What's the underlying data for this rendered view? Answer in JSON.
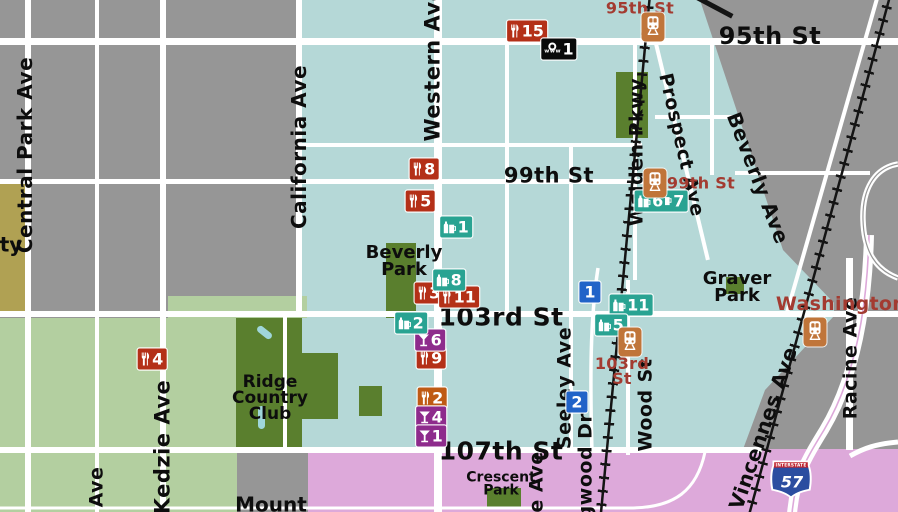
{
  "colors": {
    "background_gray": "#969696",
    "beverly_teal": "#b5d8d7",
    "golf_light_green": "#b3cfa0",
    "park_dark_green": "#5a7f2e",
    "olive_area": "#b0a153",
    "mount_greenwood_pink": "#dda9da",
    "road_white": "#ffffff",
    "railroad_black": "#141414",
    "restaurant_red": "#b43018",
    "cafe_orange": "#bf5a14",
    "bar_purple": "#8e2b8c",
    "pub_teal": "#29a392",
    "poi_blue": "#2163c8",
    "internet_black": "#0a0a0a",
    "station_orange": "#c0753a",
    "station_label_red": "#a33b31",
    "interstate_blue": "#2b4da0",
    "interstate_red": "#c02531"
  },
  "street_labels": [
    {
      "name": "95th-st",
      "text": "95th St",
      "x": 770,
      "y": 36,
      "size": 24,
      "rot": 0
    },
    {
      "name": "99th-st",
      "text": "99th St",
      "x": 549,
      "y": 176,
      "size": 21,
      "rot": 0
    },
    {
      "name": "103rd-st",
      "text": "103rd St",
      "x": 501,
      "y": 317,
      "size": 25,
      "rot": 0
    },
    {
      "name": "107th-st",
      "text": "107th St",
      "x": 501,
      "y": 451,
      "size": 25,
      "rot": 0
    },
    {
      "name": "central-park-ave",
      "text": "Central Park Ave",
      "x": 25,
      "y": 155,
      "size": 20,
      "rot": -90
    },
    {
      "name": "kedzie-ave",
      "text": "Kedzie Ave",
      "x": 163,
      "y": 447,
      "size": 21,
      "rot": -90
    },
    {
      "name": "california-ave",
      "text": "California Ave",
      "x": 299,
      "y": 147,
      "size": 20,
      "rot": -90
    },
    {
      "name": "western-ave",
      "text": "Western Ave",
      "x": 433,
      "y": 64,
      "size": 21,
      "rot": -90
    },
    {
      "name": "walden-pkwy",
      "text": "Walden Pkwy",
      "x": 637,
      "y": 152,
      "size": 19,
      "rot": -90
    },
    {
      "name": "prospect-ave",
      "text": "Prospect Ave",
      "x": 681,
      "y": 145,
      "size": 19,
      "rot": 77
    },
    {
      "name": "beverly-ave",
      "text": "Beverly Ave",
      "x": 758,
      "y": 178,
      "size": 20,
      "rot": 69
    },
    {
      "name": "seeley-ave",
      "text": "Seeley Ave",
      "x": 565,
      "y": 388,
      "size": 19,
      "rot": -90
    },
    {
      "name": "wood-st",
      "text": "Wood St",
      "x": 646,
      "y": 405,
      "size": 19,
      "rot": -90
    },
    {
      "name": "longwood-dr-partial",
      "text": "gwood Dr",
      "x": 586,
      "y": 466,
      "size": 19,
      "rot": -90
    },
    {
      "name": "ave-partial-east",
      "text": "e Ave",
      "x": 537,
      "y": 482,
      "size": 19,
      "rot": -90
    },
    {
      "name": "vincennes-ave",
      "text": "Vincennes Ave",
      "x": 763,
      "y": 428,
      "size": 20,
      "rot": -71
    },
    {
      "name": "racine-ave",
      "text": "Racine Ave",
      "x": 851,
      "y": 358,
      "size": 19,
      "rot": -90
    },
    {
      "name": "ave-partial-west",
      "text": "Ave",
      "x": 97,
      "y": 487,
      "size": 19,
      "rot": -90
    }
  ],
  "place_labels": [
    {
      "name": "beverly-park",
      "lines": [
        "Beverly",
        "Park"
      ],
      "x": 404,
      "y": 261,
      "size": 18
    },
    {
      "name": "graver-park",
      "lines": [
        "Graver",
        "Park"
      ],
      "x": 737,
      "y": 287,
      "size": 18
    },
    {
      "name": "ridge-country-club",
      "lines": [
        "Ridge",
        "Country",
        "Club"
      ],
      "x": 270,
      "y": 398,
      "size": 17
    },
    {
      "name": "crescent-park",
      "lines": [
        "Crescent",
        "Park"
      ],
      "x": 501,
      "y": 485,
      "size": 14
    },
    {
      "name": "mount-partial",
      "lines": [
        "Mount"
      ],
      "x": 271,
      "y": 505,
      "size": 20
    },
    {
      "name": "ty-partial",
      "lines": [
        "ty"
      ],
      "x": 11,
      "y": 245,
      "size": 20
    }
  ],
  "station_labels": [
    {
      "name": "station-95th",
      "lines": [
        "95th St"
      ],
      "x": 640,
      "y": 8,
      "size": 16
    },
    {
      "name": "station-99th",
      "lines": [
        "99th St"
      ],
      "x": 701,
      "y": 183,
      "size": 16
    },
    {
      "name": "station-103rd",
      "lines": [
        "103rd",
        "St"
      ],
      "x": 622,
      "y": 371,
      "size": 16
    },
    {
      "name": "station-washington",
      "lines": [
        "Washington"
      ],
      "x": 841,
      "y": 304,
      "size": 19
    }
  ],
  "stations": [
    {
      "name": "95th",
      "x": 653,
      "y": 27
    },
    {
      "name": "99th",
      "x": 655,
      "y": 183
    },
    {
      "name": "103rd",
      "x": 630,
      "y": 342
    },
    {
      "name": "washington",
      "x": 815,
      "y": 332
    }
  ],
  "markers": [
    {
      "type": "restaurant",
      "num": "15",
      "x": 527,
      "y": 31
    },
    {
      "type": "restaurant",
      "num": "8",
      "x": 424,
      "y": 169
    },
    {
      "type": "restaurant",
      "num": "5",
      "x": 420,
      "y": 201
    },
    {
      "type": "restaurant",
      "num": "3",
      "x": 429,
      "y": 293
    },
    {
      "type": "restaurant",
      "num": "11",
      "x": 459,
      "y": 297
    },
    {
      "type": "restaurant",
      "num": "9",
      "x": 431,
      "y": 358
    },
    {
      "type": "restaurant",
      "num": "4",
      "x": 152,
      "y": 359
    },
    {
      "type": "cafe",
      "num": "2",
      "x": 432,
      "y": 398
    },
    {
      "type": "bar",
      "num": "6",
      "x": 430,
      "y": 340
    },
    {
      "type": "bar",
      "num": "4",
      "x": 431,
      "y": 417
    },
    {
      "type": "bar",
      "num": "1",
      "x": 431,
      "y": 436
    },
    {
      "type": "pub",
      "num": "1",
      "x": 456,
      "y": 227
    },
    {
      "type": "pub",
      "num": "8",
      "x": 449,
      "y": 280
    },
    {
      "type": "pub",
      "num": "2",
      "x": 411,
      "y": 323
    },
    {
      "type": "pub",
      "num": "11",
      "x": 631,
      "y": 305
    },
    {
      "type": "pub",
      "num": "5",
      "x": 611,
      "y": 325
    },
    {
      "type": "pub-double",
      "nums": [
        "6",
        "7"
      ],
      "x": 661,
      "y": 201
    },
    {
      "type": "poi",
      "num": "1",
      "x": 590,
      "y": 292
    },
    {
      "type": "poi",
      "num": "2",
      "x": 577,
      "y": 402
    },
    {
      "type": "internet",
      "num": "1",
      "sub": "www",
      "x": 559,
      "y": 49
    }
  ],
  "interstate_shield": {
    "band": "INTERSTATE",
    "number": "57",
    "x": 791,
    "y": 481
  }
}
